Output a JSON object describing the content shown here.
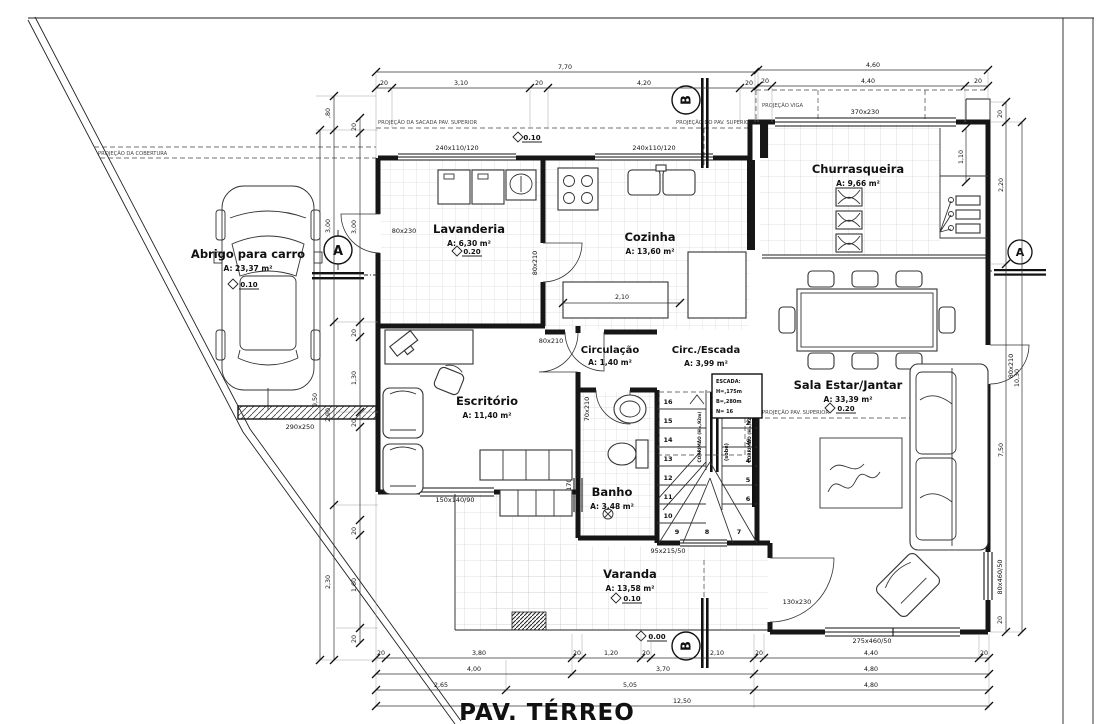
{
  "title": "PAV. TÉRREO",
  "rooms": {
    "abrigo": {
      "name": "Abrigo para carro",
      "area": "A: 23,37 m²"
    },
    "lavanderia": {
      "name": "Lavanderia",
      "area": "A: 6,30 m²"
    },
    "cozinha": {
      "name": "Cozinha",
      "area": "A: 13,60 m²"
    },
    "churrasqueira": {
      "name": "Churrasqueira",
      "area": "A: 9,66 m²"
    },
    "escritorio": {
      "name": "Escritório",
      "area": "A: 11,40 m²"
    },
    "circulacao": {
      "name": "Circulação",
      "area": "A: 1,40 m²"
    },
    "circ_escada": {
      "name": "Circ./Escada",
      "area": "A: 3,99 m²"
    },
    "sala": {
      "name": "Sala Estar/Jantar",
      "area": "A: 33,39 m²"
    },
    "banho": {
      "name": "Banho",
      "area": "A: 3,48 m²"
    },
    "varanda": {
      "name": "Varanda",
      "area": "A: 13,58 m²"
    }
  },
  "levels": {
    "p010": "0.10",
    "p020": "0.20",
    "p000": "0.00"
  },
  "openings": {
    "w240": "240x110/120",
    "w370": "370x230",
    "d80x230": "80x230",
    "d80x210": "80x210",
    "d70x210": "70x210",
    "w70": "70x60/170",
    "w150": "150x140/90",
    "w95": "95x215/50",
    "d130": "130x230",
    "w275": "275x460/50",
    "w80x460": "80x460/50",
    "w290": "290x250"
  },
  "projections": {
    "sacada": "PROJEÇÃO DA SACADA PAV. SUPERIOR",
    "pav_superior": "PROJEÇÃO DO PAV. SUPERIOR",
    "viga": "PROJEÇÃO VIGA",
    "cobertura": "PROJEÇÃO DA COBERTURA",
    "pav_superior2": "PROJEÇÃO PAV. SUPERIOR"
  },
  "markers": {
    "a": "A",
    "b": "B"
  },
  "stair": {
    "title": "ESCADA:",
    "h": "H=,175m",
    "b": "B=,280m",
    "n": "N= 16",
    "corrimao": "CORRIMÃO (H=,92m)",
    "sobe": "(sobe)",
    "steps": [
      "1",
      "2",
      "3",
      "4",
      "5",
      "6",
      "7",
      "8",
      "9",
      "10",
      "11",
      "12",
      "13",
      "14",
      "15",
      "16"
    ]
  },
  "dims": {
    "top_total": "7,70",
    "top_chain": [
      "20",
      "3,10",
      "20",
      "4,20",
      "20"
    ],
    "tr_total": "4,60",
    "tr_chain": [
      "20",
      "4,40",
      "20"
    ],
    "b1": [
      "20",
      "3,80",
      "20",
      "1,20",
      "20",
      "2,10",
      "20",
      "4,40",
      "20"
    ],
    "b2": [
      "4,00",
      "3,70",
      "4,80"
    ],
    "b3": [
      "2,65",
      "5,05",
      "4,80"
    ],
    "b_total": "12,50",
    "left_outer": [
      ",80",
      "3,00",
      "2,90",
      "2,30"
    ],
    "left_total": "9,50",
    "left_inner": [
      "20",
      "3,00",
      "20",
      "1,30",
      "20",
      "20",
      "1,60",
      "20"
    ],
    "right": [
      "20",
      "1,10",
      "2,20",
      "10,30",
      "7,50",
      "20"
    ],
    "kitchen": "2,10"
  }
}
